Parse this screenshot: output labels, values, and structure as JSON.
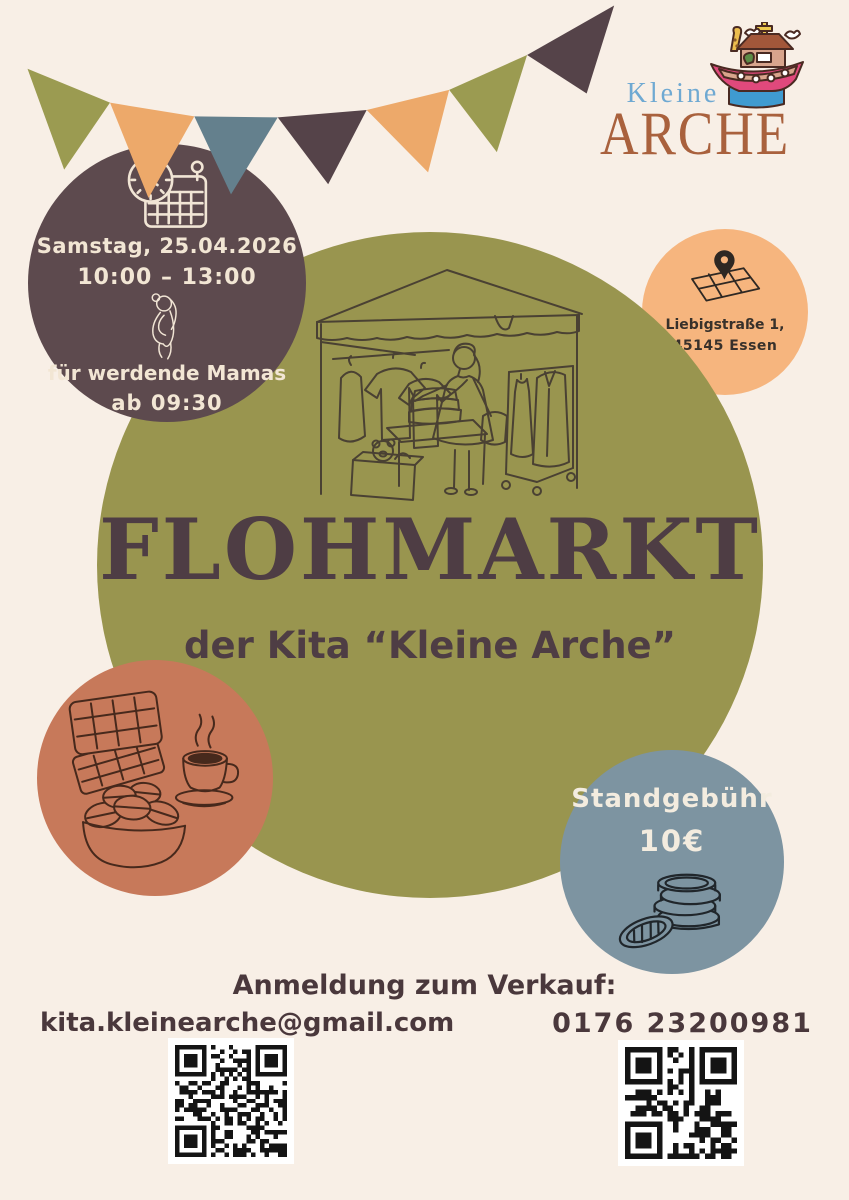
{
  "logo": {
    "kleine": "Kleine",
    "arche": "ARCHE",
    "icon": "noahs-ark-icon",
    "kleine_color": "#6fa9d2",
    "arche_color": "#a9613d"
  },
  "banner": {
    "pennant_colors": [
      "#9b9b51",
      "#eda96a",
      "#64808d",
      "#554349",
      "#eda96a",
      "#9b9b51",
      "#554349"
    ]
  },
  "date_circle": {
    "bg": "#5d4a4e",
    "icon": "calendar-clock-icon",
    "date": "Samstag, 25.04.2026",
    "time": "10:00 – 13:00",
    "icon2": "pregnant-woman-icon",
    "note_line1": "für werdende Mamas",
    "note_line2": "ab 09:30"
  },
  "location_circle": {
    "bg": "#f6b57e",
    "icon": "map-pin-icon",
    "address_line1": "Liebigstraße 1,",
    "address_line2": "45145 Essen"
  },
  "main_circle": {
    "bg": "#99954f",
    "illustration": "market-stall-illustration",
    "title": "FLOHMARKT",
    "subtitle": "der Kita “Kleine Arche”"
  },
  "food_circle": {
    "bg": "#c7795a",
    "illustration": "waffles-coffee-macarons-illustration"
  },
  "fee_circle": {
    "bg": "#7d94a1",
    "label": "Standgebühr",
    "price": "10€",
    "illustration": "coins-illustration"
  },
  "contact": {
    "heading": "Anmeldung zum Verkauf:",
    "email": "kita.kleinearche@gmail.com",
    "phone": "0176 23200981"
  },
  "colors": {
    "background": "#f8efe6",
    "title_brown": "#4e3d44",
    "cream_text": "#f2e6d4"
  }
}
